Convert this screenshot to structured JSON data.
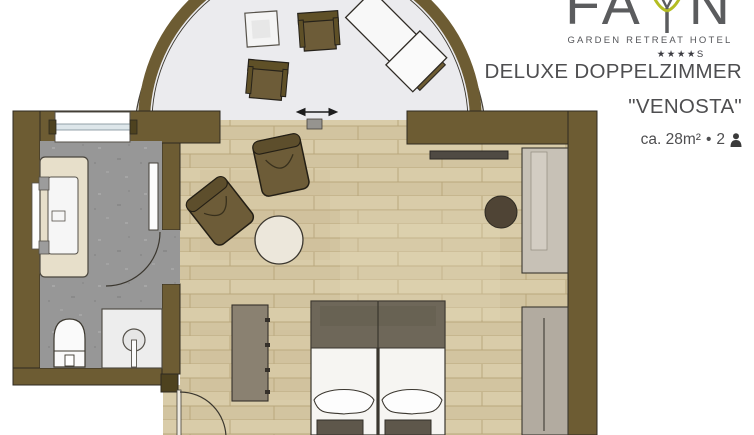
{
  "brand": {
    "name": "FAYN",
    "name_left": "FA",
    "name_right": "N",
    "tagline": "GARDEN RETREAT HOTEL",
    "stars": "★★★★",
    "stars_suffix": "S"
  },
  "room_info": {
    "title": "DELUXE DOPPELZIMMER",
    "subtitle": "\"VENOSTA\"",
    "area": "ca. 28m²",
    "bullet": "•",
    "occupancy": "2"
  },
  "colors": {
    "wall": "#6d5c33",
    "wall-dark": "#4e421f",
    "wood": "#d8cba9",
    "plank": "#b9a77d",
    "stone": "#969696",
    "balcony": "#ebebee",
    "chair": "#6d5c38",
    "outline": "#2e2a20",
    "logo-gray": "#5b5c5e",
    "logo-green": "#b4bd22",
    "text": "#4e4e50"
  }
}
